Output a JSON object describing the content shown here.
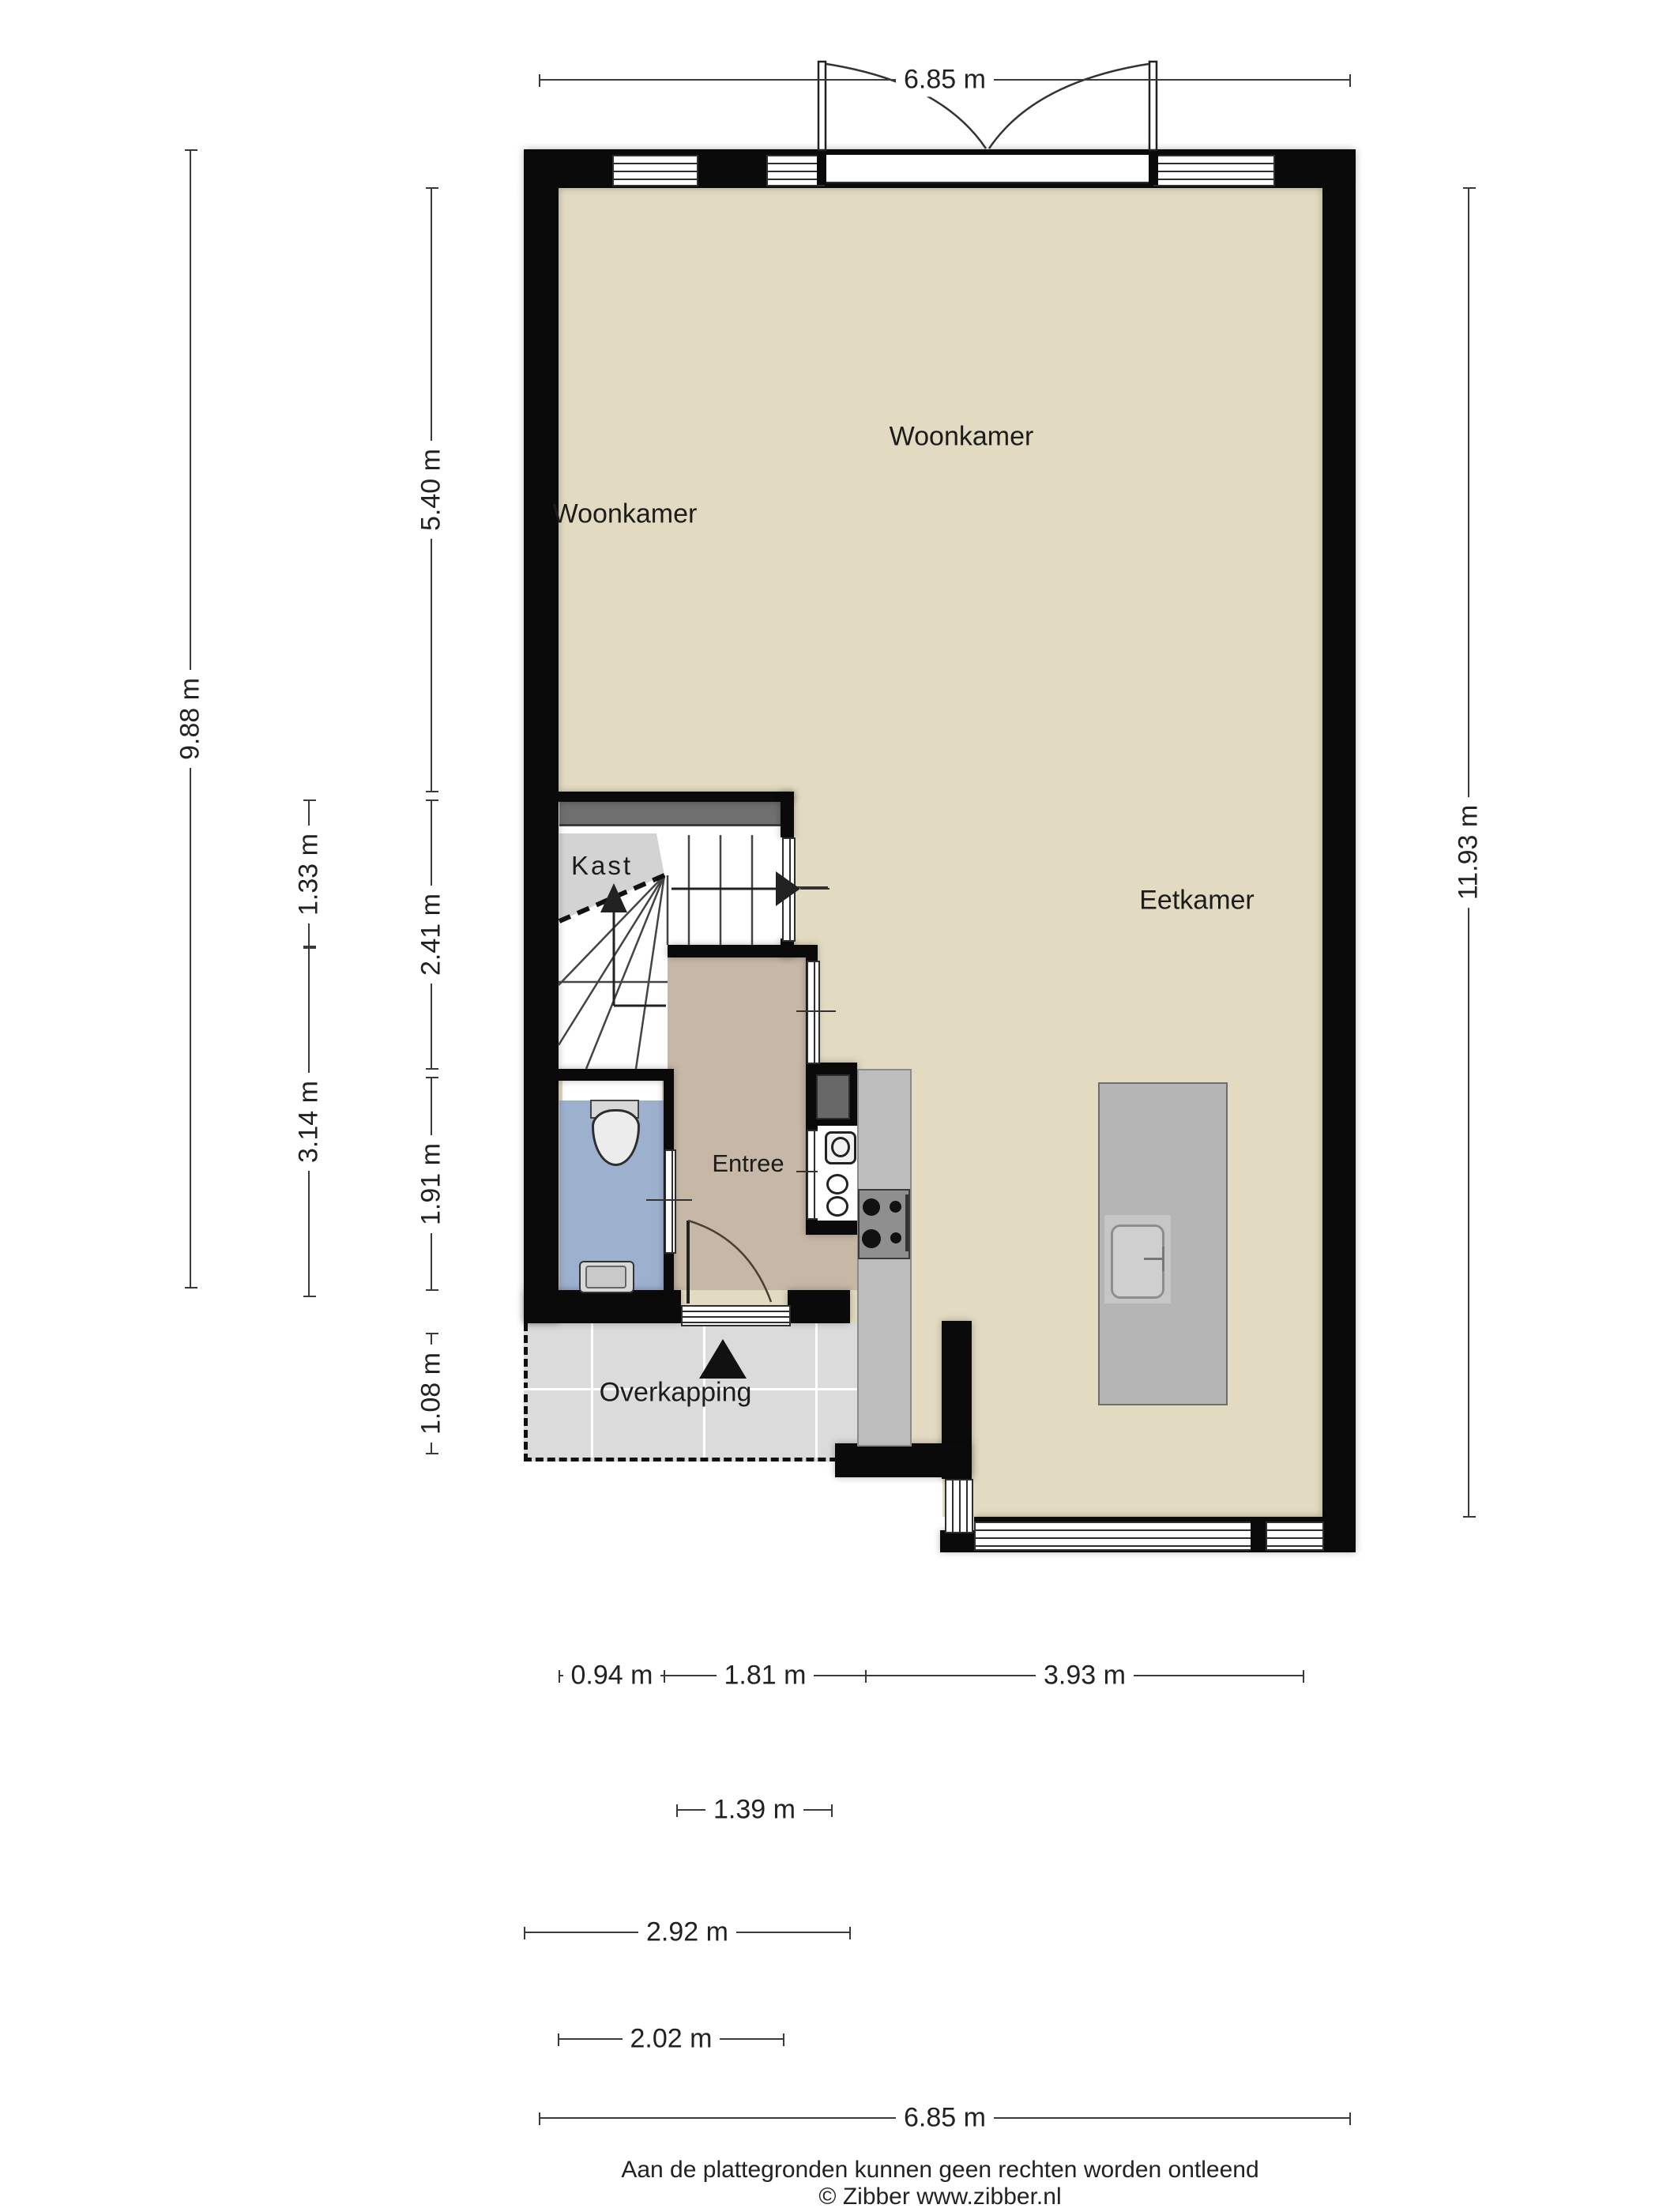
{
  "page": {
    "footer_line1": "Aan de plattegronden kunnen geen rechten worden ontleend",
    "footer_line2": "© Zibber www.zibber.nl"
  },
  "rooms": {
    "woonkamer_left": "Woonkamer",
    "woonkamer_main": "Woonkamer",
    "eetkamer": "Eetkamer",
    "kast": "Kast",
    "entree": "Entree",
    "overkapping": "Overkapping"
  },
  "dims": {
    "top_width": {
      "label": "6.85 m",
      "meters": 6.85
    },
    "right_height": {
      "label": "11.93 m",
      "meters": 11.93
    },
    "left_total": {
      "label": "9.88 m",
      "meters": 9.88
    },
    "left_livingroom": {
      "label": "5.40 m",
      "meters": 5.4
    },
    "left_landing": {
      "label": "1.33 m",
      "meters": 1.33
    },
    "left_stairblock": {
      "label": "2.41 m",
      "meters": 2.41
    },
    "left_hall": {
      "label": "3.14 m",
      "meters": 3.14
    },
    "left_toilet": {
      "label": "1.91 m",
      "meters": 1.91
    },
    "left_overkapping": {
      "label": "1.08 m",
      "meters": 1.08
    },
    "bottom_a": {
      "label": "0.94 m",
      "meters": 0.94
    },
    "bottom_b": {
      "label": "1.81 m",
      "meters": 1.81
    },
    "bottom_c": {
      "label": "3.93 m",
      "meters": 3.93
    },
    "bottom_door": {
      "label": "1.39 m",
      "meters": 1.39
    },
    "bottom_overkapping": {
      "label": "2.92 m",
      "meters": 2.92
    },
    "bottom_block": {
      "label": "2.02 m",
      "meters": 2.02
    },
    "bottom_total": {
      "label": "6.85 m",
      "meters": 6.85
    }
  },
  "colors": {
    "wall": "#0a0a0a",
    "floor_living": "#e3dbc1",
    "floor_entree": "#c6b7a6",
    "floor_toilet": "#9db0ce",
    "floor_kast": "#d3d3d3",
    "floor_overkapping": "#dbdbdb",
    "counter": "#bdbdbd",
    "island": "#b5b5b5",
    "accent_strip": "#6f6f6f"
  }
}
